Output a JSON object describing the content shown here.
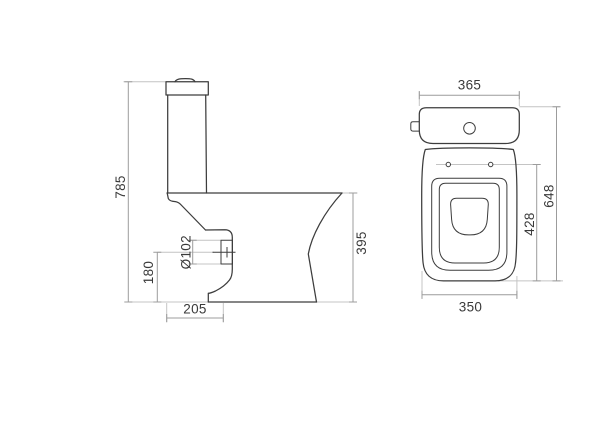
{
  "drawing": {
    "subject": "Close-coupled toilet (WC) dimensional drawing",
    "units": "mm",
    "views": [
      "side view",
      "front/top view"
    ],
    "background_color": "#ffffff",
    "outline_color": "#3d3d3d",
    "dimension_line_color": "#9c9c9c",
    "extension_line_color": "#c4c4c4",
    "label_color": "#3a3a3a"
  },
  "side_view": {
    "labels": {
      "overall_height": "785",
      "outlet_center_height": "180",
      "outlet_center_setout": "205",
      "outlet_diameter": "Ø102",
      "rim_height": "395"
    }
  },
  "top_view": {
    "labels": {
      "cistern_width": "365",
      "overall_depth": "648",
      "fixing_holes_to_front": "428",
      "bowl_width": "350"
    }
  }
}
